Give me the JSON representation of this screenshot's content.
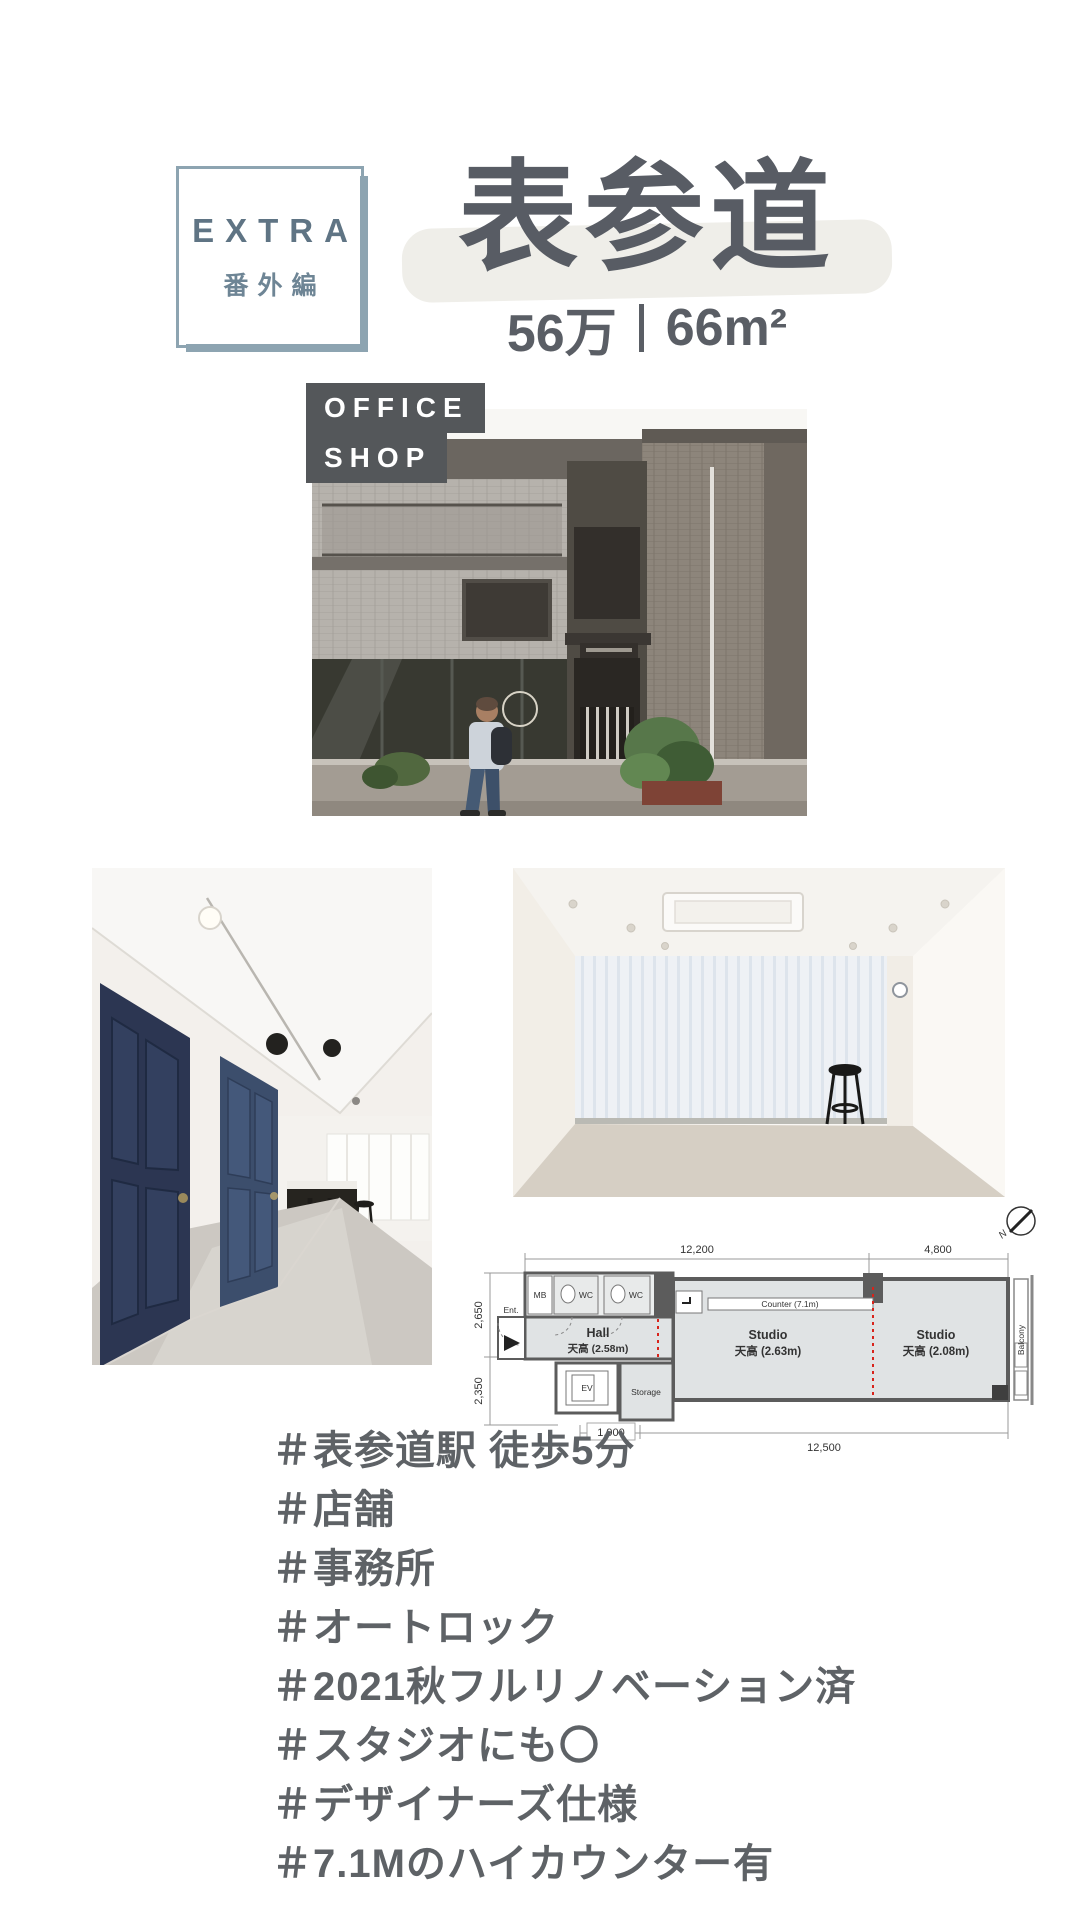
{
  "badge": {
    "title": "EXTRA",
    "subtitle": "番外編"
  },
  "header": {
    "title": "表参道",
    "price": "56万",
    "separator": "｜",
    "area": "66m²"
  },
  "photo_label": {
    "line1": "OFFICE",
    "line2": "SHOP"
  },
  "floorplan": {
    "compass": "N",
    "dims": {
      "top_main": "12,200",
      "top_right": "4,800",
      "left_upper": "2,650",
      "left_lower": "2,350",
      "bottom_small": "1,900",
      "bottom_main": "12,500"
    },
    "labels": {
      "mb": "MB",
      "wc_left": "WC",
      "wc_right": "WC",
      "ent": "Ent.",
      "hall": "Hall",
      "hall_ceiling": "天高 (2.58m)",
      "counter": "Counter (7.1m)",
      "studio_main": "Studio",
      "studio_main_ceiling": "天高 (2.63m)",
      "studio_sub": "Studio",
      "studio_sub_ceiling": "天高 (2.08m)",
      "ev": "EV",
      "storage": "Storage",
      "balcony": "Balcony"
    }
  },
  "hashtags": [
    "＃表参道駅 徒歩5分",
    "＃店舗",
    "＃事務所",
    "＃オートロック",
    "＃2021秋フルリノベーション済",
    "＃スタジオにも〇",
    "＃デザイナーズ仕様",
    "＃7.1Mのハイカウンター有"
  ],
  "colors": {
    "accent_bluegray": "#8da4b1",
    "text_dark": "#5a5e66",
    "badge_text": "#5f7484",
    "label_bg": "#54575a",
    "title_highlight": "#efeee9",
    "plan_red": "#d8231b"
  }
}
